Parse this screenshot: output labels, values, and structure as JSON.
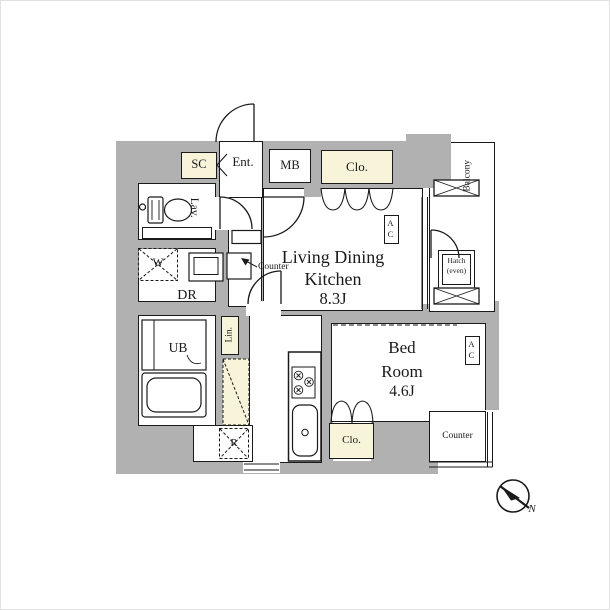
{
  "meta": {
    "type": "apartment-floor-plan"
  },
  "colors": {
    "wall_gray": "#b1b1b1",
    "accent_cream": "#f8f4da",
    "line_black": "#1a1a1a",
    "background": "#ffffff"
  },
  "rooms": {
    "living_dining_kitchen": {
      "label_line1": "Living Dining",
      "label_line2": "Kitchen",
      "size": "8.3J"
    },
    "bedroom": {
      "label_line1": "Bed",
      "label_line2": "Room",
      "size": "4.6J"
    },
    "entrance": {
      "label": "Ent."
    },
    "lavatory": {
      "label": "Lav."
    },
    "dressing_room": {
      "label": "DR"
    },
    "unit_bath": {
      "label": "UB"
    },
    "balcony": {
      "label": "Balcony"
    }
  },
  "features": {
    "shoe_closet": {
      "label": "SC"
    },
    "meter_box": {
      "label": "MB"
    },
    "closet_living": {
      "label": "Clo."
    },
    "closet_bedroom": {
      "label": "Clo."
    },
    "linen_closet": {
      "label": "Lin."
    },
    "washer_space": {
      "label": "W"
    },
    "refrigerator_space": {
      "label": "R"
    },
    "kitchen_counter": {
      "label": "Counter"
    },
    "bedroom_counter": {
      "label": "Counter"
    },
    "ac_living": {
      "label": "AC"
    },
    "ac_bedroom": {
      "label": "AC"
    },
    "hatch": {
      "label_line1": "Hatch",
      "label_line2": "(even)"
    }
  },
  "compass": {
    "label": "N"
  }
}
